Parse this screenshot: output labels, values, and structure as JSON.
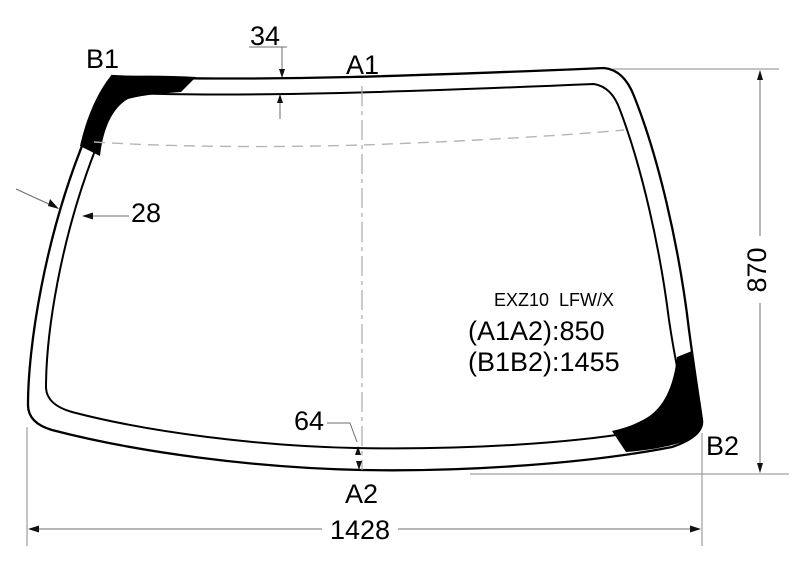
{
  "diagram": {
    "kind": "windshield-dimension-drawing",
    "labels": {
      "b1": "B1",
      "a1": "A1",
      "a2": "A2",
      "b2": "B2"
    },
    "dimensions": {
      "top_band": "34",
      "side_band": "28",
      "bottom_band": "64",
      "height": "870",
      "width": "1428"
    },
    "info": {
      "part_code": "EXZ10  LFW/X",
      "a1a2_note": "(A1A2):850",
      "b1b2_note": "(B1B2):1455"
    },
    "colors": {
      "outline": "#000000",
      "frit_patch": "#000000",
      "dimension_lines": "#6e6e6e",
      "dashed_guides": "#b5b5b5",
      "background": "#ffffff"
    }
  }
}
